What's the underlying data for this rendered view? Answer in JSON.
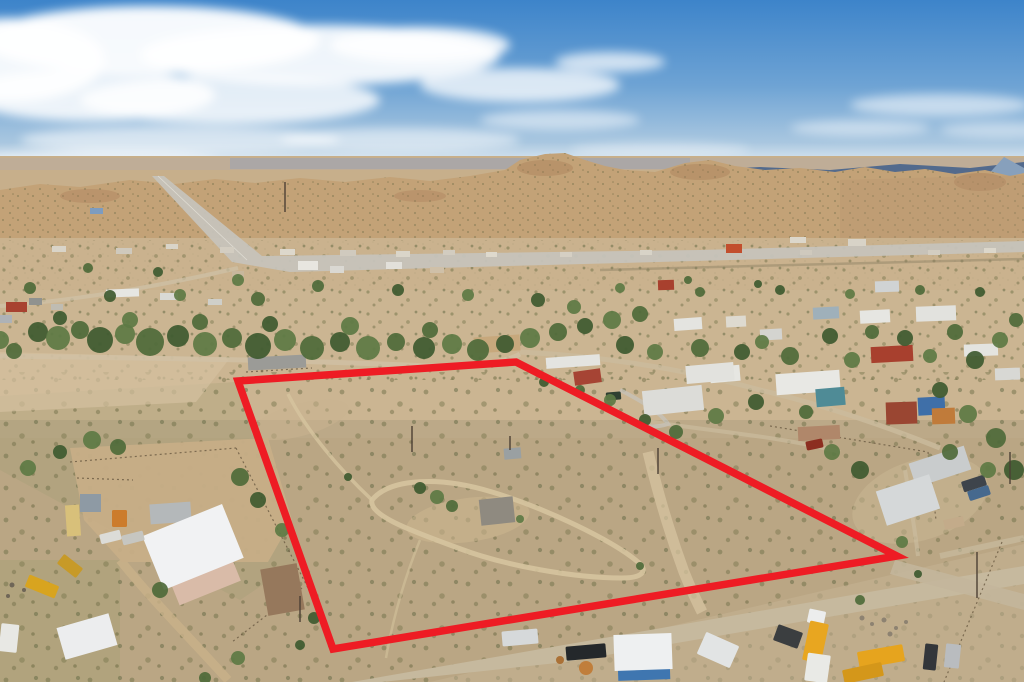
{
  "meta": {
    "description": "Aerial drone photograph of a high-desert neighborhood with a vacant scrub lot outlined in red, highway and mesas in the distance",
    "width": 1024,
    "height": 682
  },
  "palette": {
    "sky_top": "#3d84ca",
    "sky_horizon": "#dde9f0",
    "mountain_far": "#46638c",
    "mesa": "#c3a277",
    "valley": "#ccb694",
    "foreground": "#ab9b7d",
    "dirt_road": "#c6b99e",
    "boundary_red": "#ee1c24",
    "tree_shades": [
      "#4e6a3a",
      "#3e5a30",
      "#5d7a44"
    ]
  },
  "boundary": {
    "color": "#ee1c24",
    "stroke_width": 7.5,
    "points": "238,381 516,362 897,556 333,649"
  },
  "clouds": [
    [
      10,
      60,
      95,
      42,
      0.92
    ],
    [
      150,
      40,
      170,
      34,
      0.95
    ],
    [
      320,
      55,
      180,
      30,
      0.9
    ],
    [
      90,
      95,
      125,
      26,
      0.85
    ],
    [
      230,
      100,
      150,
      24,
      0.8
    ],
    [
      420,
      45,
      90,
      18,
      0.85
    ],
    [
      520,
      85,
      100,
      17,
      0.75
    ],
    [
      610,
      62,
      55,
      10,
      0.7
    ],
    [
      180,
      140,
      160,
      14,
      0.55
    ],
    [
      400,
      140,
      120,
      12,
      0.5
    ],
    [
      90,
      162,
      130,
      11,
      0.5
    ],
    [
      300,
      168,
      140,
      9,
      0.45
    ],
    [
      560,
      120,
      80,
      10,
      0.5
    ],
    [
      660,
      150,
      90,
      8,
      0.35
    ],
    [
      940,
      105,
      90,
      11,
      0.55
    ],
    [
      860,
      128,
      70,
      8,
      0.45
    ],
    [
      1000,
      130,
      60,
      8,
      0.4
    ]
  ],
  "buildings": [
    [
      90,
      208,
      13,
      6,
      "#7d9cc0",
      0
    ],
    [
      52,
      246,
      14,
      6,
      "#d9d4c8",
      0
    ],
    [
      116,
      248,
      16,
      6,
      "#cfc9bd",
      0
    ],
    [
      166,
      244,
      12,
      5,
      "#d9d4c8",
      0
    ],
    [
      220,
      247,
      14,
      6,
      "#d3cdc1",
      0
    ],
    [
      280,
      249,
      15,
      6,
      "#ddd8cc",
      0
    ],
    [
      340,
      250,
      16,
      6,
      "#d0cabe",
      0
    ],
    [
      396,
      251,
      14,
      6,
      "#dad5c9",
      0
    ],
    [
      443,
      250,
      12,
      5,
      "#d2ccc0",
      0
    ],
    [
      486,
      252,
      11,
      5,
      "#ded9cd",
      0
    ],
    [
      560,
      252,
      12,
      5,
      "#d5cfc3",
      0
    ],
    [
      640,
      250,
      12,
      5,
      "#d8d3c7",
      0
    ],
    [
      726,
      244,
      16,
      9,
      "#c24e2d",
      0
    ],
    [
      790,
      237,
      16,
      6,
      "#dcd7cb",
      0
    ],
    [
      848,
      239,
      18,
      7,
      "#d8d3c7",
      0
    ],
    [
      800,
      250,
      12,
      5,
      "#cfc9bd",
      0
    ],
    [
      928,
      250,
      12,
      5,
      "#d3cdc1",
      0
    ],
    [
      984,
      248,
      12,
      5,
      "#dcd7cb",
      0
    ],
    [
      298,
      261,
      20,
      9,
      "#e8e6e0",
      0
    ],
    [
      330,
      266,
      14,
      7,
      "#dad8d2",
      0
    ],
    [
      386,
      262,
      16,
      7,
      "#e2e0da",
      0
    ],
    [
      430,
      267,
      14,
      6,
      "#cfc0a8",
      0
    ],
    [
      232,
      271,
      12,
      6,
      "#c8b79c",
      0
    ],
    [
      6,
      302,
      21,
      10,
      "#a84230",
      0
    ],
    [
      29,
      298,
      13,
      7,
      "#90928f",
      0
    ],
    [
      0,
      315,
      12,
      8,
      "#aeb2b6",
      0
    ],
    [
      51,
      304,
      12,
      6,
      "#bfbcb2",
      0
    ],
    [
      106,
      289,
      33,
      8,
      "#e6e6e2",
      -2
    ],
    [
      160,
      293,
      18,
      7,
      "#d9d9d5",
      0
    ],
    [
      208,
      299,
      14,
      6,
      "#cfcfc9",
      0
    ],
    [
      658,
      280,
      16,
      10,
      "#a8402e",
      -2
    ],
    [
      875,
      281,
      24,
      11,
      "#d0d3d4",
      -2
    ],
    [
      248,
      356,
      58,
      13,
      "#9b9b97",
      -3
    ],
    [
      474,
      336,
      46,
      16,
      "#c7a87c",
      -4
    ],
    [
      546,
      356,
      54,
      11,
      "#e4e4e0",
      -4
    ],
    [
      574,
      370,
      27,
      14,
      "#a64434",
      -8
    ],
    [
      643,
      388,
      60,
      25,
      "#dcdcd8",
      -6
    ],
    [
      710,
      366,
      30,
      16,
      "#e6e6e2",
      -5
    ],
    [
      674,
      318,
      28,
      12,
      "#e4e4e0",
      -4
    ],
    [
      726,
      316,
      20,
      11,
      "#dedad0",
      -3
    ],
    [
      760,
      329,
      22,
      11,
      "#d4d4d0",
      -3
    ],
    [
      813,
      307,
      26,
      12,
      "#9fb0ba",
      -3
    ],
    [
      860,
      310,
      30,
      13,
      "#e6e6e2",
      -3
    ],
    [
      916,
      306,
      40,
      15,
      "#e2e2de",
      -2
    ],
    [
      871,
      346,
      42,
      16,
      "#a8402e",
      -3
    ],
    [
      776,
      372,
      64,
      21,
      "#e8e8e4",
      -4
    ],
    [
      686,
      364,
      48,
      18,
      "#e2e2de",
      -5
    ],
    [
      816,
      388,
      29,
      18,
      "#4f8b96",
      -5
    ],
    [
      918,
      397,
      27,
      18,
      "#3f6fa8",
      -3
    ],
    [
      886,
      402,
      31,
      22,
      "#9a4632",
      -2
    ],
    [
      932,
      408,
      23,
      16,
      "#c07b3a",
      -2
    ],
    [
      964,
      344,
      34,
      12,
      "#e4e4e0",
      -2
    ],
    [
      995,
      368,
      25,
      12,
      "#d8d8d4",
      -2
    ],
    [
      798,
      426,
      42,
      14,
      "#b0876a",
      -3
    ],
    [
      911,
      454,
      58,
      25,
      "#c9cccd",
      -18
    ],
    [
      880,
      482,
      56,
      36,
      "#d5d8d9",
      -18
    ],
    [
      944,
      518,
      20,
      10,
      "#c3ab8a",
      -12
    ],
    [
      80,
      494,
      21,
      18,
      "#8e9aa4",
      0
    ],
    [
      150,
      503,
      41,
      20,
      "#b4b8ba",
      -4
    ],
    [
      66,
      505,
      14,
      31,
      "#d8c07a",
      -4
    ],
    [
      172,
      566,
      66,
      28,
      "#d9bba8",
      -22
    ],
    [
      150,
      518,
      86,
      58,
      "#f1f2f3",
      -22
    ],
    [
      60,
      620,
      54,
      33,
      "#ecedee",
      -16
    ],
    [
      264,
      566,
      37,
      47,
      "#96785c",
      -10
    ],
    [
      618,
      662,
      52,
      18,
      "#3f76b0",
      -2
    ],
    [
      614,
      634,
      58,
      36,
      "#eef0f1",
      -2
    ],
    [
      504,
      448,
      17,
      11,
      "#9aa0a2",
      -5
    ],
    [
      480,
      498,
      34,
      26,
      "#8f8a80",
      -6
    ]
  ],
  "vehicles": [
    [
      502,
      630,
      36,
      15,
      "#d6d9da",
      -5
    ],
    [
      566,
      645,
      40,
      14,
      "#24282b",
      -5
    ],
    [
      700,
      638,
      36,
      24,
      "#e2e4e4",
      24
    ],
    [
      775,
      628,
      26,
      17,
      "#3b3e40",
      20
    ],
    [
      808,
      610,
      17,
      14,
      "#eceded",
      12
    ],
    [
      806,
      622,
      19,
      40,
      "#e8a620",
      12
    ],
    [
      858,
      648,
      46,
      17,
      "#e6a41e",
      -10
    ],
    [
      843,
      666,
      40,
      14,
      "#d4971a",
      -12
    ],
    [
      806,
      654,
      23,
      28,
      "#e9eae6",
      8
    ],
    [
      924,
      644,
      13,
      26,
      "#33363a",
      6
    ],
    [
      945,
      644,
      15,
      24,
      "#b9bcbf",
      6
    ],
    [
      962,
      478,
      24,
      11,
      "#3e444b",
      -18
    ],
    [
      968,
      488,
      22,
      10,
      "#46698e",
      -18
    ],
    [
      806,
      440,
      17,
      9,
      "#8c2e20",
      -12
    ],
    [
      606,
      392,
      15,
      8,
      "#2f3f31",
      -5
    ],
    [
      100,
      532,
      21,
      10,
      "#dcdcd8",
      -14
    ],
    [
      122,
      533,
      22,
      10,
      "#c6c6c1",
      -14
    ],
    [
      0,
      624,
      18,
      28,
      "#e8e8e4",
      6
    ],
    [
      26,
      580,
      32,
      13,
      "#d8a41f",
      22
    ],
    [
      58,
      560,
      24,
      12,
      "#c79a28",
      38
    ],
    [
      112,
      510,
      15,
      17,
      "#cc7c2c",
      0
    ]
  ],
  "trees": [
    [
      88,
      268,
      5
    ],
    [
      158,
      272,
      5
    ],
    [
      238,
      280,
      6
    ],
    [
      318,
      286,
      6
    ],
    [
      398,
      290,
      6
    ],
    [
      468,
      295,
      6
    ],
    [
      30,
      288,
      6
    ],
    [
      110,
      296,
      6
    ],
    [
      180,
      295,
      6
    ],
    [
      258,
      299,
      7
    ],
    [
      538,
      300,
      7
    ],
    [
      574,
      307,
      7
    ],
    [
      688,
      280,
      4
    ],
    [
      758,
      284,
      4
    ],
    [
      620,
      288,
      5
    ],
    [
      700,
      292,
      5
    ],
    [
      780,
      290,
      5
    ],
    [
      850,
      294,
      5
    ],
    [
      920,
      290,
      5
    ],
    [
      980,
      292,
      5
    ],
    [
      0,
      340,
      9
    ],
    [
      14,
      351,
      8
    ],
    [
      38,
      332,
      10
    ],
    [
      58,
      338,
      12
    ],
    [
      80,
      330,
      9
    ],
    [
      100,
      340,
      13
    ],
    [
      125,
      334,
      10
    ],
    [
      150,
      342,
      14
    ],
    [
      178,
      336,
      11
    ],
    [
      205,
      344,
      12
    ],
    [
      232,
      338,
      10
    ],
    [
      258,
      346,
      13
    ],
    [
      285,
      340,
      11
    ],
    [
      312,
      348,
      12
    ],
    [
      340,
      342,
      10
    ],
    [
      368,
      348,
      12
    ],
    [
      396,
      342,
      9
    ],
    [
      424,
      348,
      11
    ],
    [
      452,
      344,
      10
    ],
    [
      478,
      350,
      11
    ],
    [
      505,
      344,
      9
    ],
    [
      530,
      338,
      10
    ],
    [
      558,
      332,
      9
    ],
    [
      585,
      326,
      8
    ],
    [
      612,
      320,
      9
    ],
    [
      640,
      314,
      8
    ],
    [
      60,
      318,
      7
    ],
    [
      130,
      320,
      8
    ],
    [
      200,
      322,
      8
    ],
    [
      270,
      324,
      8
    ],
    [
      350,
      326,
      9
    ],
    [
      430,
      330,
      8
    ],
    [
      625,
      345,
      9
    ],
    [
      655,
      352,
      8
    ],
    [
      700,
      348,
      9
    ],
    [
      742,
      352,
      8
    ],
    [
      762,
      342,
      7
    ],
    [
      790,
      356,
      9
    ],
    [
      830,
      336,
      8
    ],
    [
      852,
      360,
      8
    ],
    [
      872,
      332,
      7
    ],
    [
      905,
      338,
      8
    ],
    [
      930,
      356,
      7
    ],
    [
      955,
      332,
      8
    ],
    [
      975,
      360,
      9
    ],
    [
      1000,
      340,
      8
    ],
    [
      1016,
      320,
      7
    ],
    [
      940,
      390,
      8
    ],
    [
      968,
      414,
      9
    ],
    [
      996,
      438,
      10
    ],
    [
      1014,
      470,
      10
    ],
    [
      988,
      470,
      8
    ],
    [
      950,
      452,
      8
    ],
    [
      860,
      470,
      9
    ],
    [
      832,
      452,
      8
    ],
    [
      806,
      412,
      7
    ],
    [
      756,
      402,
      8
    ],
    [
      716,
      416,
      8
    ],
    [
      676,
      432,
      7
    ],
    [
      645,
      420,
      6
    ],
    [
      610,
      400,
      6
    ],
    [
      580,
      390,
      5
    ],
    [
      544,
      382,
      5
    ],
    [
      902,
      542,
      6
    ],
    [
      860,
      600,
      5
    ],
    [
      918,
      574,
      4
    ],
    [
      92,
      440,
      9
    ],
    [
      118,
      447,
      8
    ],
    [
      60,
      452,
      7
    ],
    [
      28,
      468,
      8
    ],
    [
      240,
      477,
      9
    ],
    [
      258,
      500,
      8
    ],
    [
      282,
      530,
      7
    ],
    [
      160,
      590,
      8
    ],
    [
      314,
      618,
      6
    ],
    [
      238,
      658,
      7
    ],
    [
      205,
      678,
      6
    ],
    [
      420,
      488,
      6
    ],
    [
      437,
      497,
      7
    ],
    [
      452,
      506,
      6
    ],
    [
      348,
      477,
      4
    ],
    [
      520,
      519,
      4
    ],
    [
      640,
      566,
      4
    ],
    [
      300,
      645,
      5
    ],
    [
      586,
      668,
      7,
      "#c07a34"
    ],
    [
      560,
      660,
      4,
      "#a86a2e"
    ]
  ],
  "poles": [
    [
      285,
      182,
      212
    ],
    [
      412,
      426,
      452
    ],
    [
      510,
      436,
      450
    ],
    [
      658,
      448,
      474
    ],
    [
      977,
      552,
      598
    ],
    [
      1010,
      452,
      484
    ],
    [
      300,
      596,
      622
    ]
  ]
}
